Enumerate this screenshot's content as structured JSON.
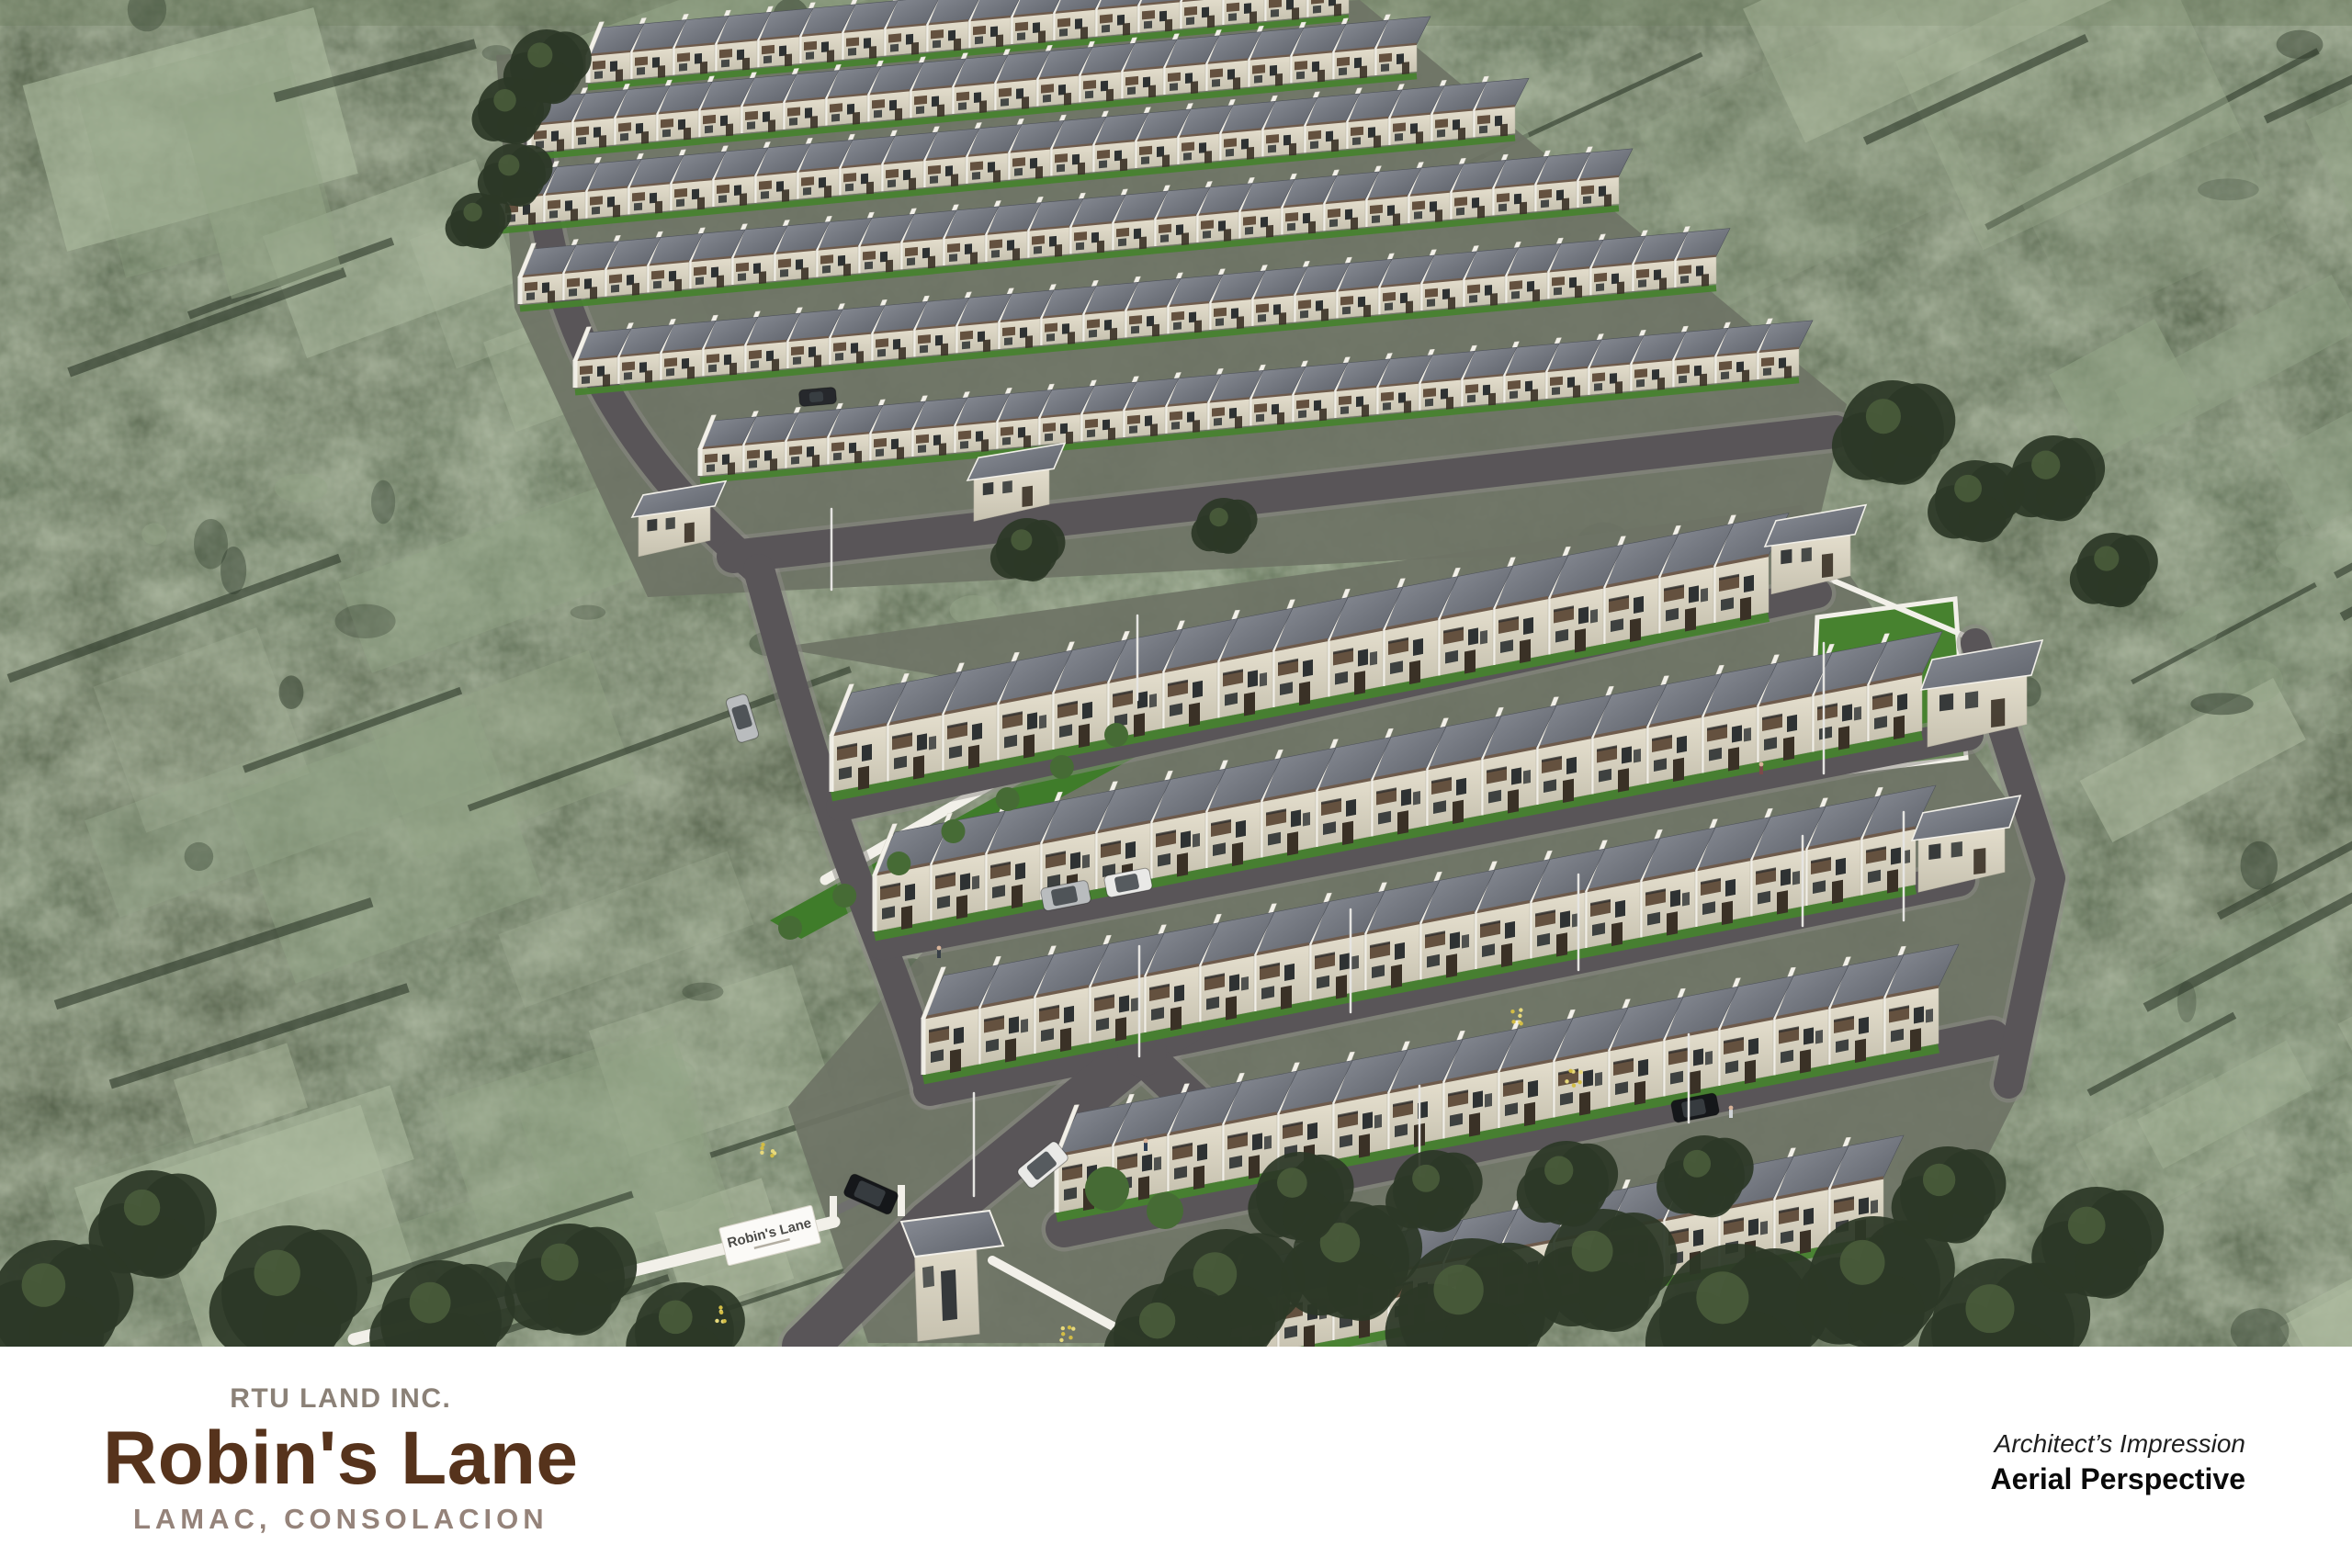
{
  "footer": {
    "company": "RTU LAND INC.",
    "project": "Robin's Lane",
    "location": "LAMAC, CONSOLACION",
    "note_line1": "Architect’s Impression",
    "note_line2": "Aerial Perspective"
  },
  "entrance_sign": {
    "text": "Robin's Lane"
  },
  "scene": {
    "description": "Aerial 3D rendering of the Robin's Lane townhouse subdivision surrounded by green fields and trees",
    "clusters": [
      {
        "name": "upper-cluster",
        "rows": 6
      },
      {
        "name": "middle-cluster",
        "rows": 3
      },
      {
        "name": "lower-cluster",
        "rows": 2
      }
    ],
    "features": [
      "entrance-gate",
      "guard-house",
      "perimeter-wall",
      "street-lamps",
      "lawns",
      "internal-roads"
    ],
    "vehicles": [
      "white-suv",
      "silver-suv",
      "white-sedan",
      "silver-hatchback",
      "black-suv",
      "black-sedan"
    ]
  },
  "colors": {
    "terrain_base": "#46523c",
    "terrain_dark": "#2d392a",
    "terrain_light": "#93a487",
    "terrain_pale": "#aebca0",
    "estate_ground": "#6e7365",
    "road": "#595558",
    "road_edge": "#8d8b87",
    "roof_fascia": "#6e5b4c",
    "trim_white": "#f2f0e9",
    "window_dark": "#2e3233",
    "wood_accent": "#64513f",
    "lawn": "#47822f",
    "lawn_bright": "#3f7c2a",
    "bush": "#466b35",
    "tree_dark": "#2c3827",
    "tree_mid": "#4b5e3c",
    "flower_yellow": "#d3bd45",
    "flower_light": "#e7d97c",
    "car_white": "#e9e9e7",
    "car_silver": "#b9bcbe",
    "car_black": "#15171a",
    "pole": "#e6e5e2",
    "sign_text": "#4b4b48"
  }
}
